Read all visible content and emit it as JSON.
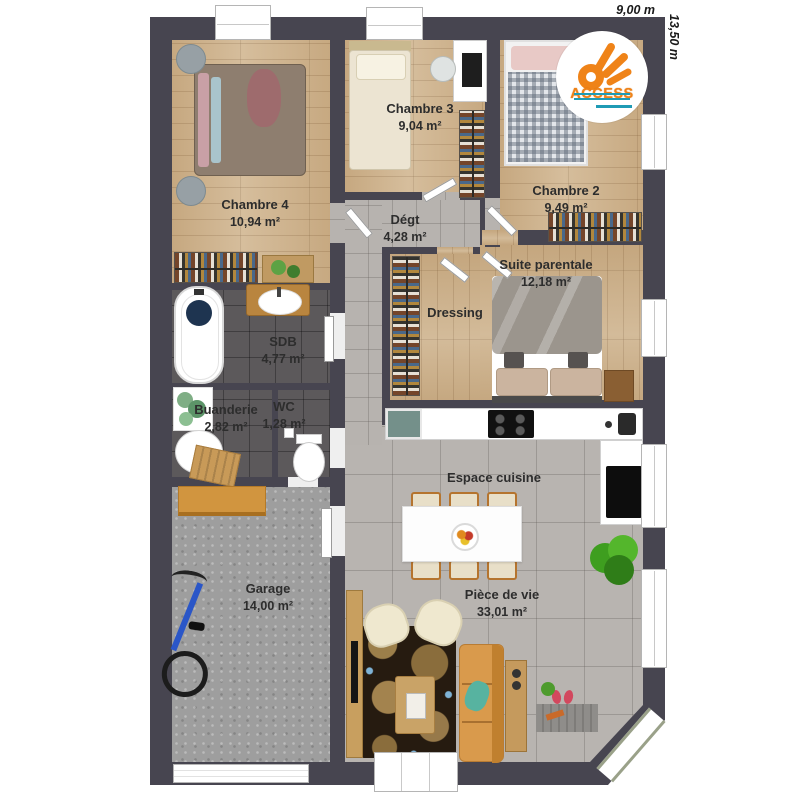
{
  "rooms": {
    "chambre4": {
      "name": "Chambre 4",
      "area": "10,94 m²"
    },
    "chambre3": {
      "name": "Chambre 3",
      "area": "9,04 m²"
    },
    "chambre2": {
      "name": "Chambre 2",
      "area": "9,49 m²"
    },
    "degt": {
      "name": "Dégt",
      "area": "4,28 m²"
    },
    "suite": {
      "name": "Suite parentale",
      "area": "12,18 m²"
    },
    "dressing": {
      "name": "Dressing"
    },
    "sdb": {
      "name": "SDB",
      "area": "4,77 m²"
    },
    "buanderie": {
      "name": "Buanderie",
      "area": "2,82 m²"
    },
    "wc": {
      "name": "WC",
      "area": "1,28 m²"
    },
    "garage": {
      "name": "Garage",
      "area": "14,00 m²"
    },
    "cuisine": {
      "name": "Espace cuisine"
    },
    "piece_de_vie": {
      "name": "Pièce de vie",
      "area": "33,01 m²"
    }
  },
  "dimensions": {
    "width": "9,00 m",
    "height": "13,50 m"
  },
  "logo": {
    "text": "ACCESS"
  },
  "colors": {
    "wall": "#474550",
    "wood": "#cfb38c",
    "brand_orange": "#ef8318",
    "brand_teal": "#1f9bb5"
  }
}
